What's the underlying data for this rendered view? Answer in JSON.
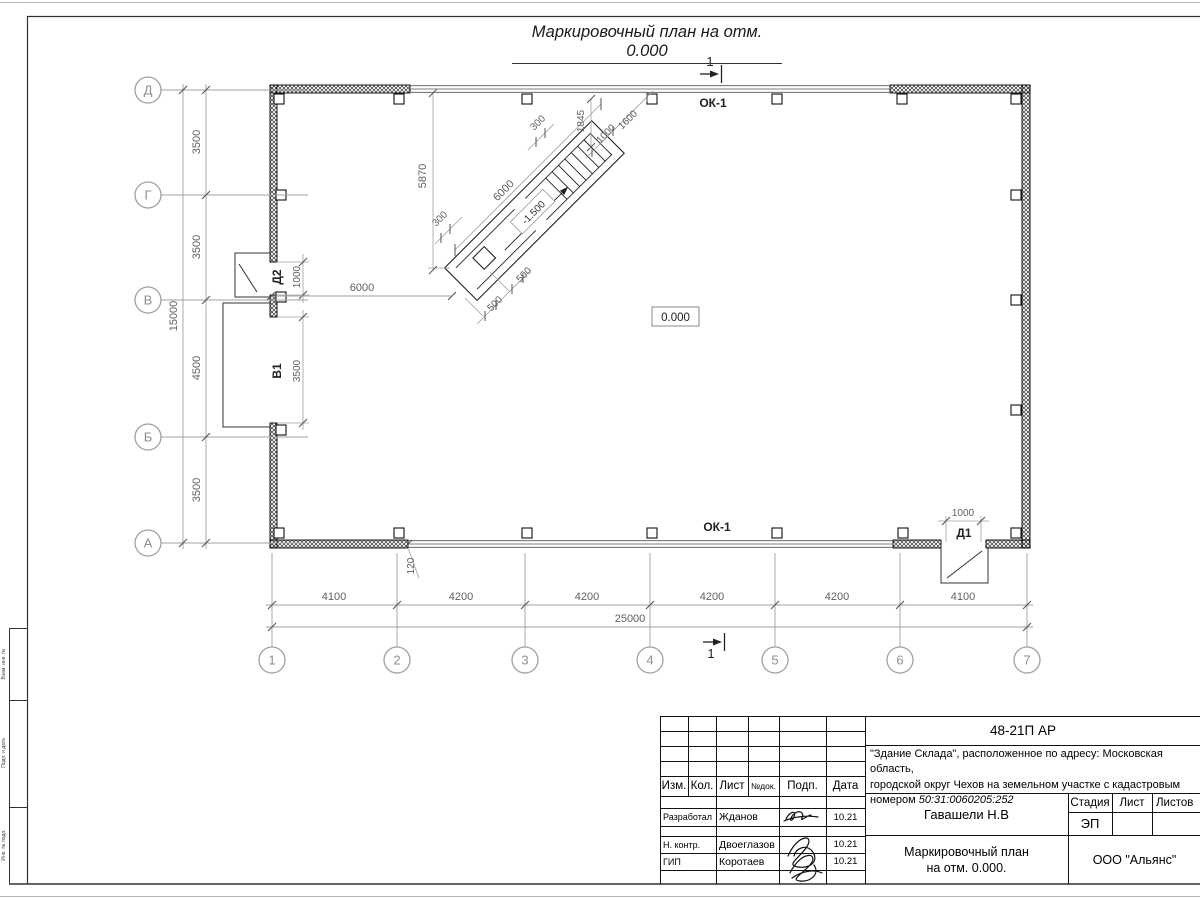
{
  "sheet": {
    "title": "Маркировочный план на отм. 0.000",
    "margin_labels": {
      "top": "Взам. инв. №",
      "middle": "Подп. и дата",
      "bottom": "Инв. № подл."
    }
  },
  "plan": {
    "window_label_top": "ОК-1",
    "window_label_bottom": "ОК-1",
    "door1": "Д1",
    "door2": "Д2",
    "gate": "В1",
    "level_main": "0.000",
    "level_stairs": "-1.500",
    "section_number": "1",
    "axes_rows": [
      "Д",
      "Г",
      "В",
      "Б",
      "А"
    ],
    "axes_cols": [
      "1",
      "2",
      "3",
      "4",
      "5",
      "6",
      "7"
    ],
    "dims": {
      "row_segments": [
        "3500",
        "3500",
        "4500",
        "3500"
      ],
      "row_total": "15000",
      "col_segments": [
        "4100",
        "4200",
        "4200",
        "4200",
        "4200",
        "4100"
      ],
      "col_total": "25000",
      "d2_width": "1000",
      "v1_width": "3500",
      "wall_to_stairs": "6000",
      "d1_width": "1000",
      "offset": "120",
      "stairs_height": "5870",
      "stairs_length": "6000",
      "stairs_w1": "300",
      "stairs_w2": "300",
      "stairs_run": "1845",
      "stairs_top_width": "1600",
      "stairs_top_offset": "1000",
      "stairs_s1": "500",
      "stairs_s2": "500"
    }
  },
  "titleblock": {
    "code": "48-21П АР",
    "object_line1": "\"Здание Склада\", расположенное по адресу: Московская область,",
    "object_line2": "городской округ Чехов на земельном участке с кадастровым",
    "object_line3_prefix": "номером ",
    "object_line3_cadastre": "50:31:0060205:252",
    "cols": {
      "izm": "Изм.",
      "kol": "Кол.",
      "list": "Лист",
      "ndok": "№док.",
      "podp": "Подп.",
      "data": "Дата"
    },
    "rows": [
      {
        "role": "Разработал",
        "name": "Жданов",
        "date": "10.21"
      },
      {
        "role": "Н. контр.",
        "name": "Двоеглазов",
        "date": "10.21"
      },
      {
        "role": "ГИП",
        "name": "Коротаев",
        "date": "10.21"
      }
    ],
    "approver": "Гавашели Н.В",
    "stage_label": "Стадия",
    "sheet_label": "Лист",
    "sheets_label": "Листов",
    "stage": "ЭП",
    "doc_name1": "Маркировочный план",
    "doc_name2": "на отм. 0.000.",
    "company": "ООО \"Альянс\""
  }
}
